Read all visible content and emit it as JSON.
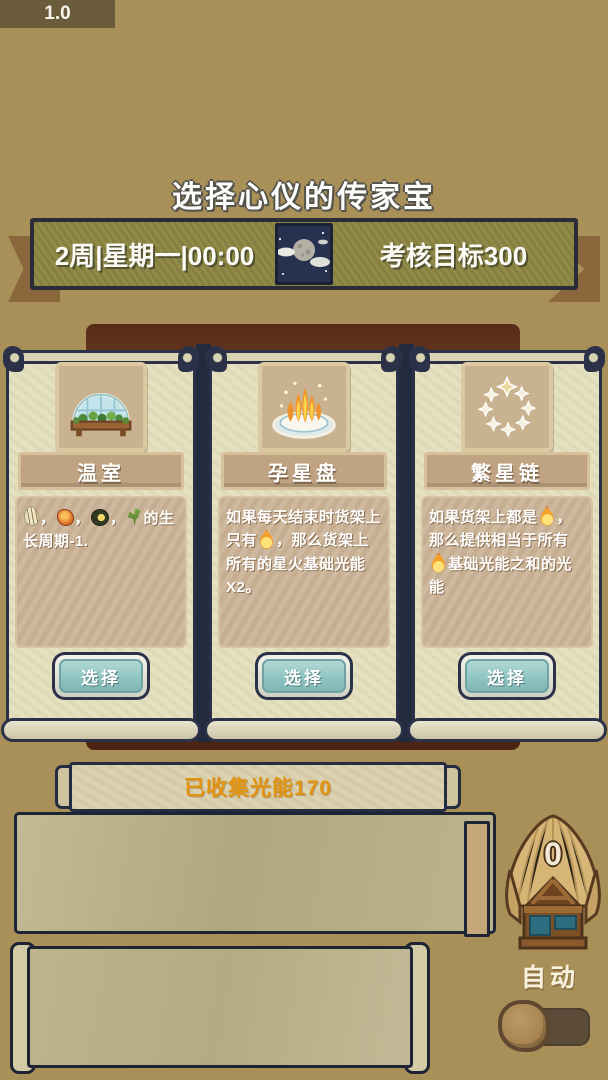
{
  "version_label": "1.0",
  "page_title": "选择心仪的传家宝",
  "banner": {
    "schedule": "2周|星期一|00:00",
    "goal": "考核目标300",
    "icon": "moon"
  },
  "cards": [
    {
      "title": "温室",
      "icon": "greenhouse",
      "button_label": "选择",
      "desc": [
        {
          "icon": "seed-pod"
        },
        {
          "text": "，"
        },
        {
          "icon": "orange-bloom"
        },
        {
          "text": "，"
        },
        {
          "icon": "avocado-seed"
        },
        {
          "text": "，"
        },
        {
          "icon": "sprout"
        },
        {
          "text": "的生长周期-1."
        }
      ]
    },
    {
      "title": "孕星盘",
      "icon": "star-plate",
      "button_label": "选择",
      "desc": [
        {
          "text": "如果每天结束时货架上只有"
        },
        {
          "icon": "flame"
        },
        {
          "text": "，那么货架上所有的星火基础光能X2。"
        }
      ]
    },
    {
      "title": "繁星链",
      "icon": "star-ring",
      "button_label": "选择",
      "desc": [
        {
          "text": "如果货架上都是"
        },
        {
          "icon": "flame"
        },
        {
          "text": "，那么提供相当于所有"
        },
        {
          "icon": "flame"
        },
        {
          "text": "基础光能之和的光能"
        }
      ]
    }
  ],
  "collected_banner": {
    "label": "已收集光能170"
  },
  "hut": {
    "count": "0"
  },
  "auto_toggle": {
    "label": "自动",
    "state": "off"
  },
  "colors": {
    "bg": "#a98f58",
    "navy": "#2b3148",
    "backdrop-brown": "#6a3a22",
    "banner-olive": "#8d8642",
    "card-cream": "#e4dfbd",
    "desc-tan": "#cbb499",
    "button-teal": "#8fc5c3",
    "accent-orange": "#e2930f",
    "straw": "#d6b576",
    "toggle-brown": "#5d4b39"
  }
}
